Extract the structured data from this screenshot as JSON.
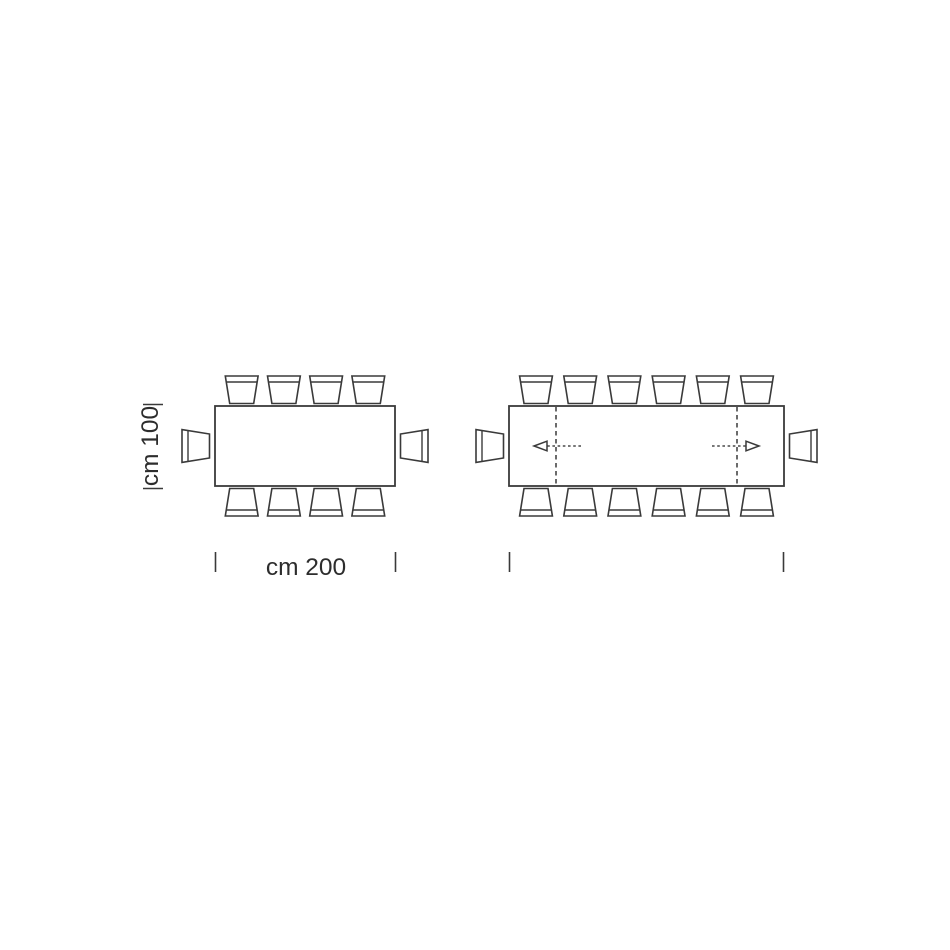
{
  "page": {
    "background": "#ffffff",
    "stroke_color": "#3a3a3a",
    "text_color": "#2d2d2d"
  },
  "diagram": {
    "type": "furniture-dimension-plan",
    "subject": "rectangular dining table top view, closed and extended configurations",
    "dimensions": {
      "height_label": "cm 100",
      "width_label": "cm 200"
    },
    "tables": [
      {
        "id": "closed",
        "top_chairs": 4,
        "bottom_chairs": 4,
        "end_chairs": 2,
        "total_seats": 10,
        "extension_arrows": false
      },
      {
        "id": "extended",
        "top_chairs": 6,
        "bottom_chairs": 6,
        "end_chairs": 2,
        "total_seats": 14,
        "extension_arrows": true
      }
    ]
  }
}
